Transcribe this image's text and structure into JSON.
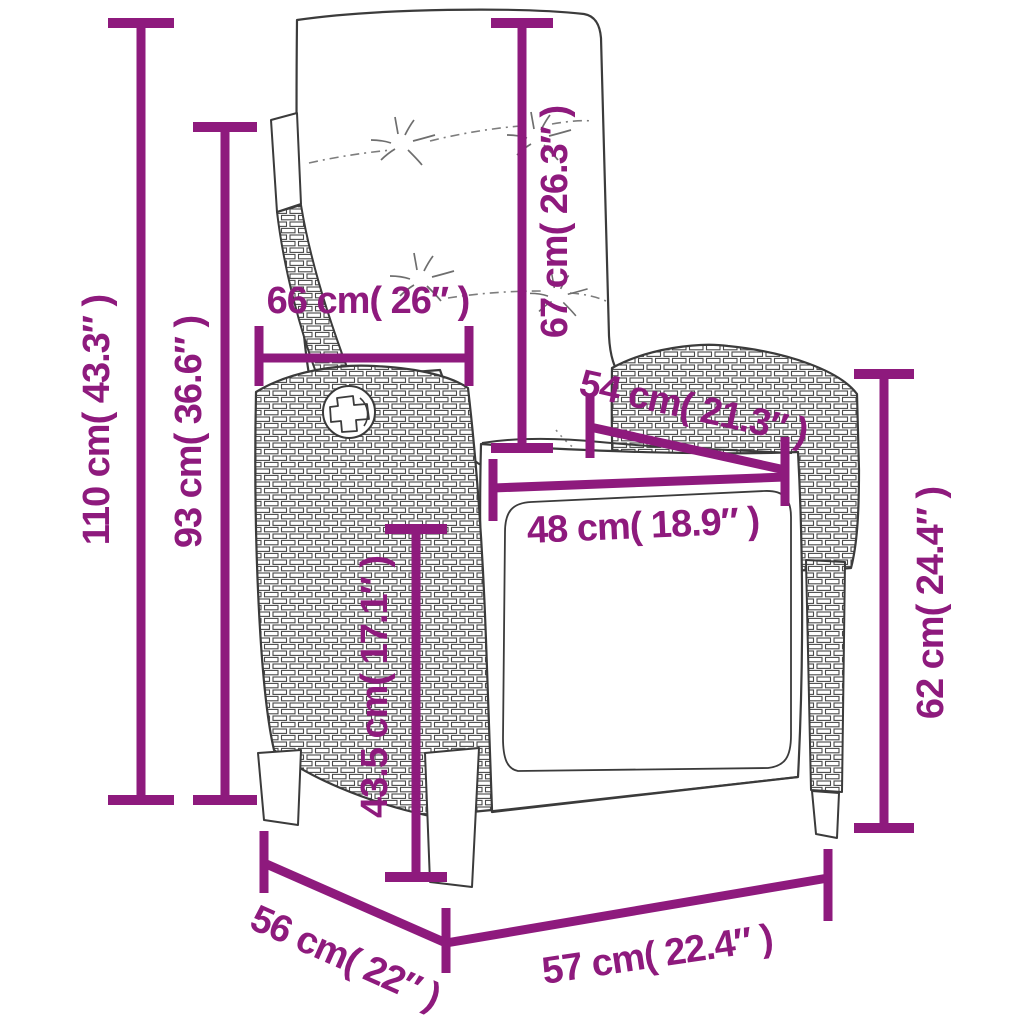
{
  "diagram": {
    "kind": "product-dimension-diagram",
    "product": "reclining-wicker-garden-chair-with-cushions",
    "background": "#ffffff",
    "accent_color": "#8E1A7D",
    "outline_color": "#3B3B3B",
    "dimensions": {
      "total_height": {
        "label": "110 cm( 43.3″ )",
        "cm": 110,
        "inch": 43.3
      },
      "backrest_height": {
        "label": "93 cm( 36.6″ )",
        "cm": 93,
        "inch": 36.6
      },
      "back_width": {
        "label": "66 cm( 26″ )",
        "cm": 66,
        "inch": 26
      },
      "backrest_length": {
        "label": "67 cm( 26.3″ )",
        "cm": 67,
        "inch": 26.3
      },
      "seat_diagonal": {
        "label": "54 cm( 21.3″ )",
        "cm": 54,
        "inch": 21.3
      },
      "seat_width": {
        "label": "48 cm( 18.9″ )",
        "cm": 48,
        "inch": 18.9
      },
      "seat_height": {
        "label": "43.5 cm( 17.1″ )",
        "cm": 43.5,
        "inch": 17.1
      },
      "armrest_height": {
        "label": "62 cm( 24.4″ )",
        "cm": 62,
        "inch": 24.4
      },
      "depth": {
        "label": "56 cm( 22″ )",
        "cm": 56,
        "inch": 22
      },
      "width": {
        "label": "57 cm( 22.4″ )",
        "cm": 57,
        "inch": 22.4
      }
    }
  }
}
